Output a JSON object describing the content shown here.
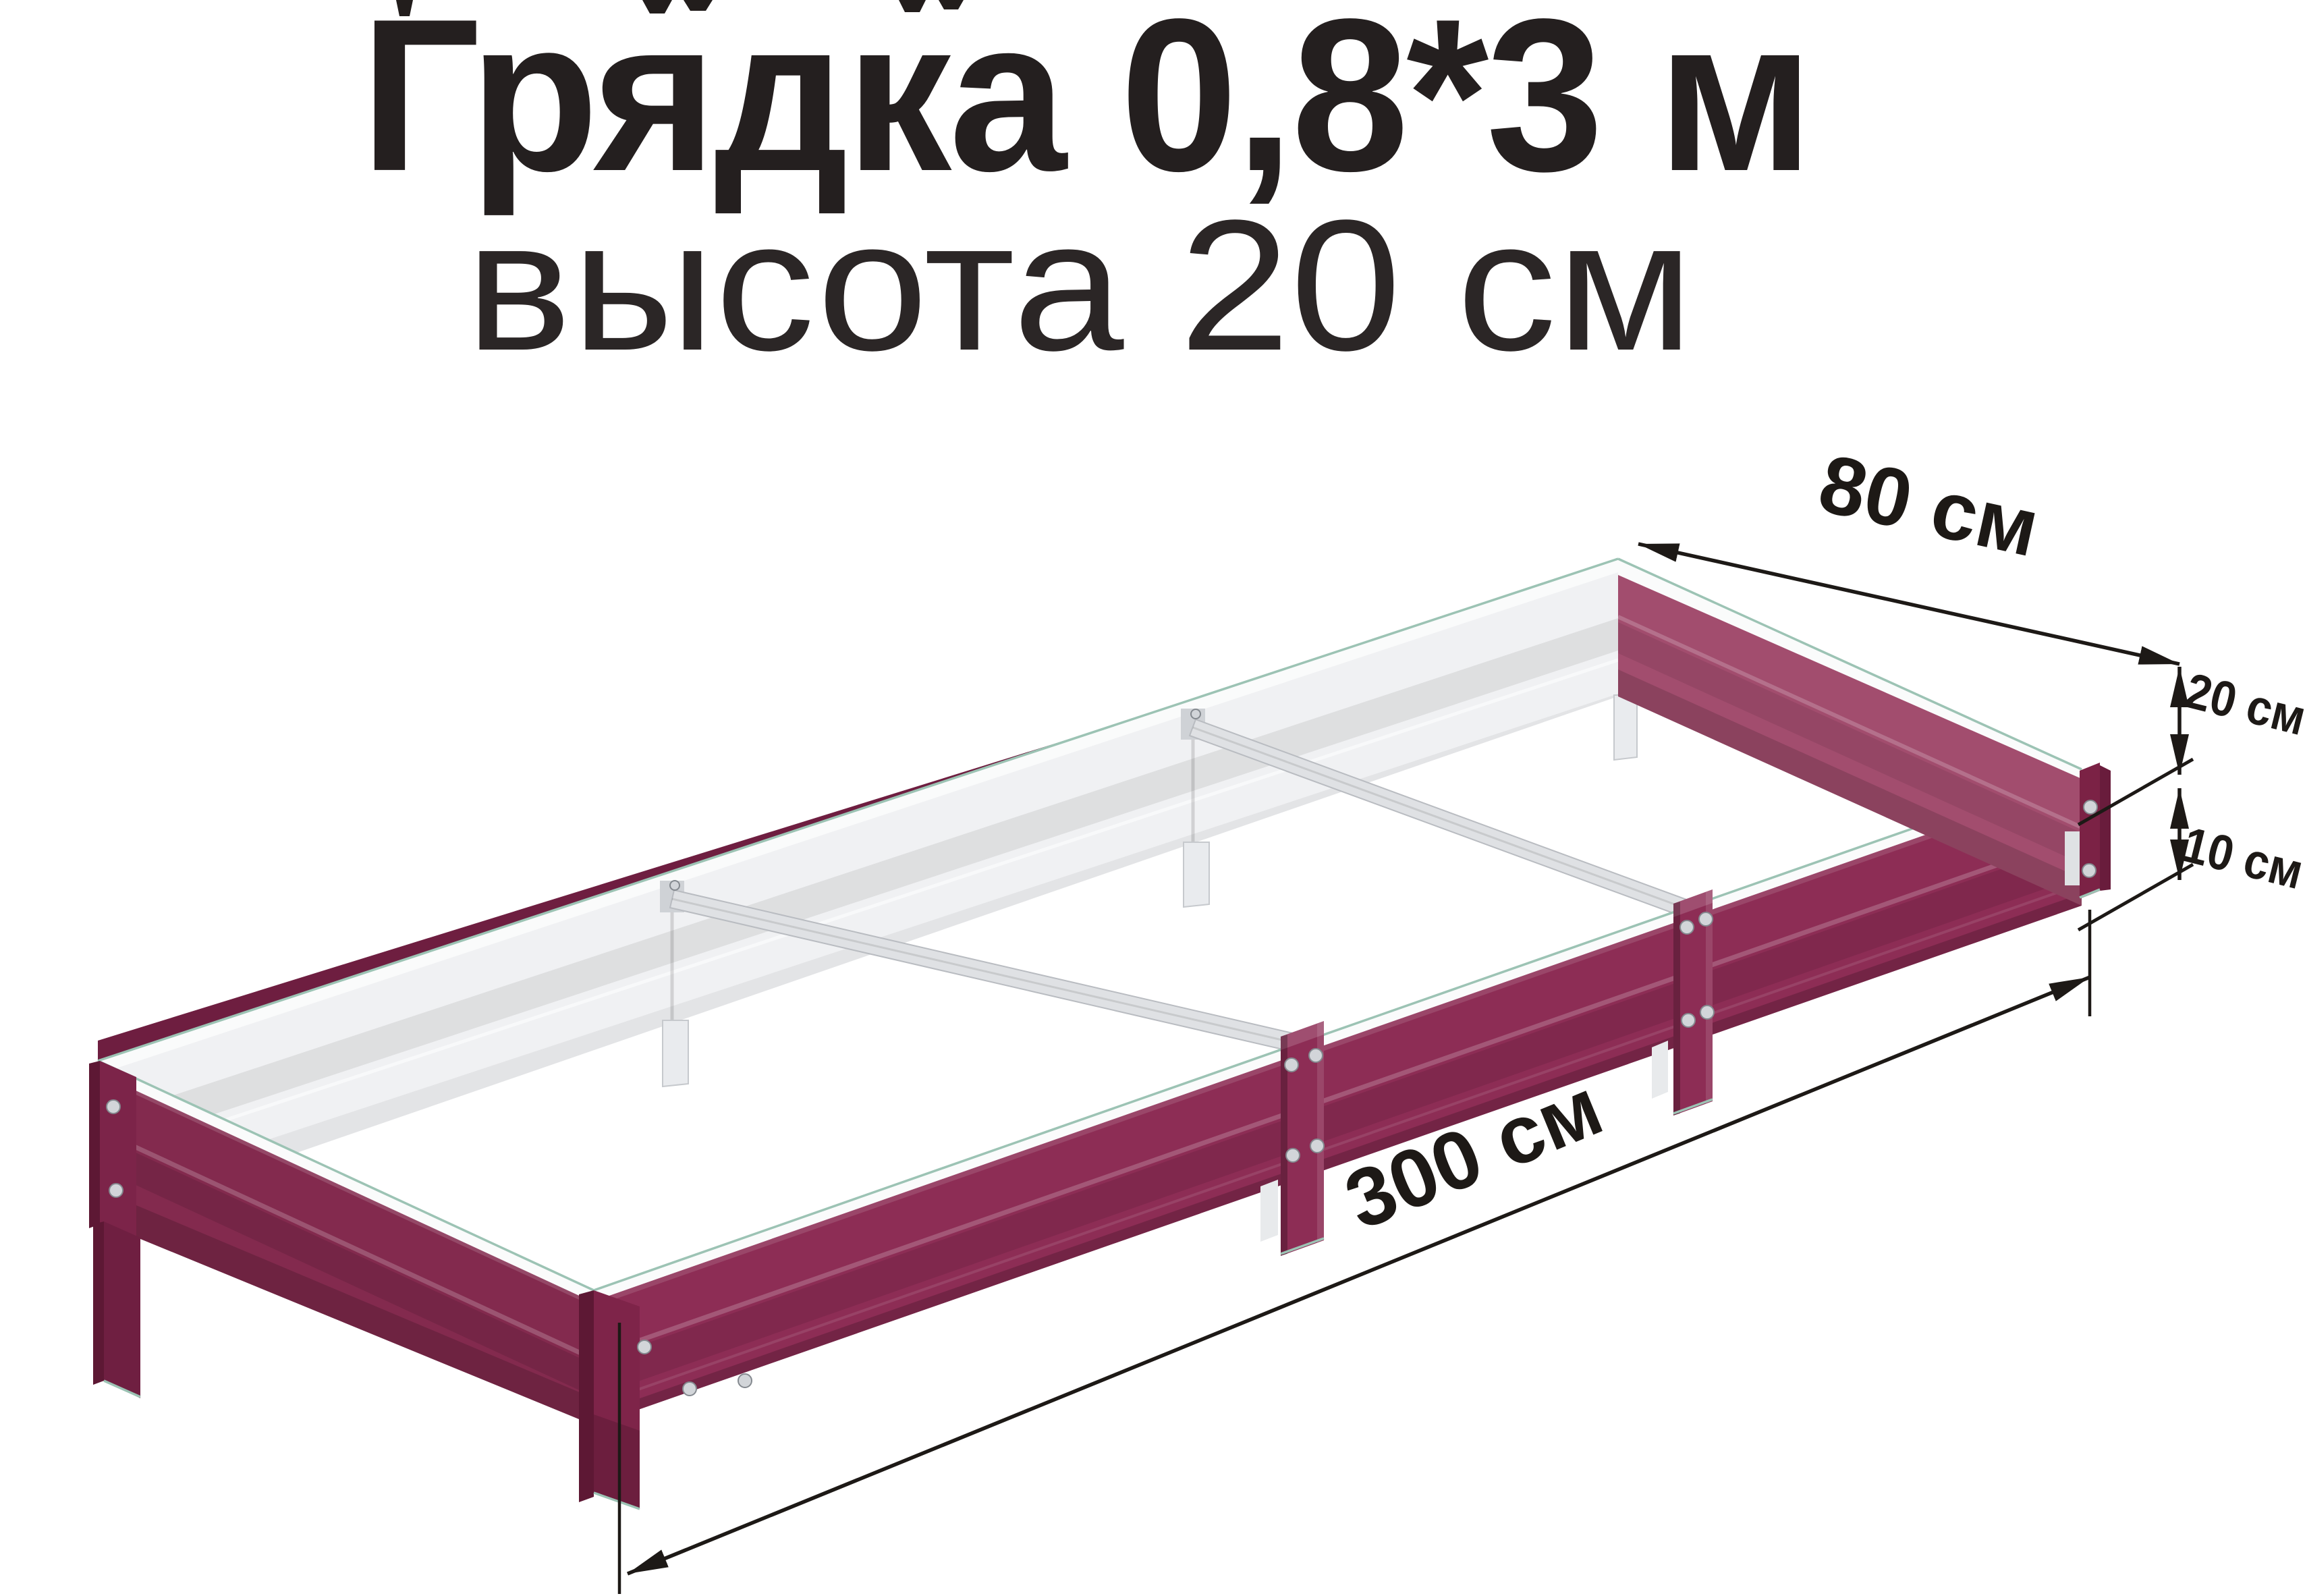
{
  "title": {
    "line1": "Грядка 0,8*3 м",
    "line2": "высота 20 см"
  },
  "dimensions": {
    "width": {
      "label": "80 см"
    },
    "height_total": {
      "label": "20 см"
    },
    "height_ground": {
      "label": "10 см"
    },
    "length": {
      "label": "300 см"
    }
  },
  "colors": {
    "background": "#ffffff",
    "text_primary": "#241f1f",
    "text_secondary": "#2b2626",
    "dim": "#1d1916",
    "bed_front": "#8d2d55",
    "bed_right_end": "#a24d6e",
    "bed_left_end": "#832a4e",
    "bed_shadow": "#5d1834",
    "interior_white": "#f0f1f3",
    "rim_white": "#fafbfb",
    "edge_teal": "#9cc3b4",
    "rivet": "#d2d5d9"
  }
}
